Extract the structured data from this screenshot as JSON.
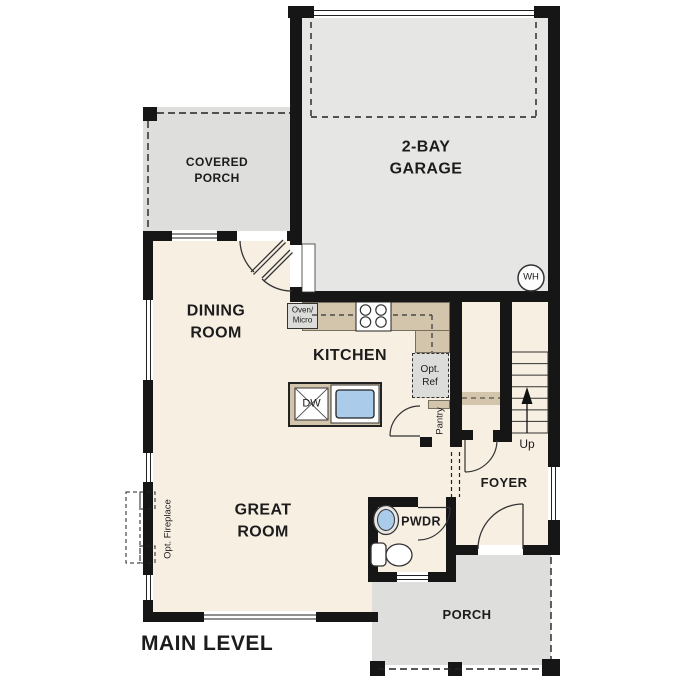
{
  "plan": {
    "title": "MAIN LEVEL",
    "rooms": {
      "covered_porch": "COVERED\nPORCH",
      "garage": "2-BAY\nGARAGE",
      "dining": "DINING\nROOM",
      "kitchen": "KITCHEN",
      "great_room": "GREAT\nROOM",
      "foyer": "FOYER",
      "powder": "PWDR",
      "porch": "PORCH"
    },
    "fixtures": {
      "water_heater": "WH",
      "oven_micro": "Oven/\nMicro",
      "opt_ref": "Opt.\nRef",
      "pantry": "Pantry",
      "dishwasher": "DW",
      "opt_fireplace": "Opt. Fireplace"
    },
    "stairs": {
      "direction": "Up"
    },
    "colors": {
      "wall": "#161616",
      "interior": "#f7efe2",
      "garage-floor": "#e6e6e4",
      "porch-floor": "#dededc",
      "counter": "#d3c5ab",
      "appliance": "#dcdcda",
      "water": "#aacbe9",
      "line": "#333333"
    }
  }
}
